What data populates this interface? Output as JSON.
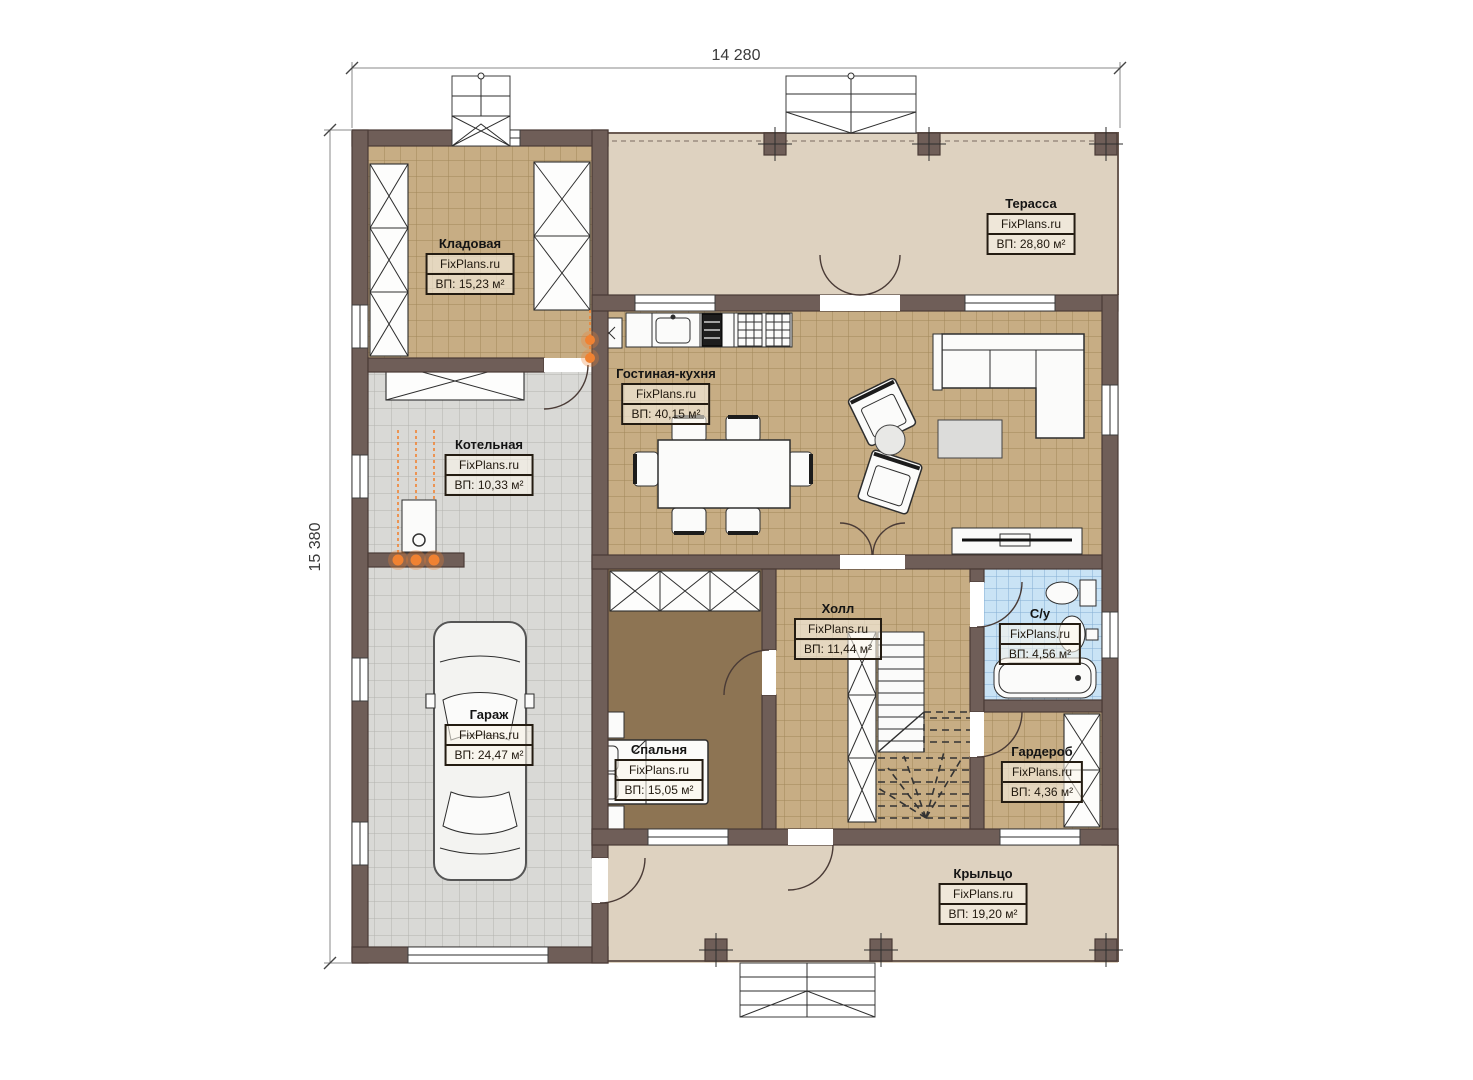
{
  "plan": {
    "title": "House first floor plan",
    "brand": "FixPlans.ru"
  },
  "dimensions": {
    "width_label": "14 280",
    "height_label": "15 380"
  },
  "rooms": [
    {
      "id": "kladovaya",
      "name": "Кладовая",
      "watermark": "FixPlans.ru",
      "area": "ВП: 15,23 м²"
    },
    {
      "id": "terrassa",
      "name": "Терасса",
      "watermark": "FixPlans.ru",
      "area": "ВП: 28,80 м²"
    },
    {
      "id": "kotelnaya",
      "name": "Котельная",
      "watermark": "FixPlans.ru",
      "area": "ВП: 10,33 м²"
    },
    {
      "id": "gostinaya",
      "name": "Гостиная-кухня",
      "watermark": "FixPlans.ru",
      "area": "ВП: 40,15 м²"
    },
    {
      "id": "garazh",
      "name": "Гараж",
      "watermark": "FixPlans.ru",
      "area": "ВП: 24,47 м²"
    },
    {
      "id": "spalnya",
      "name": "Спальня",
      "watermark": "FixPlans.ru",
      "area": "ВП: 15,05 м²"
    },
    {
      "id": "holl",
      "name": "Холл",
      "watermark": "FixPlans.ru",
      "area": "ВП: 11,44 м²"
    },
    {
      "id": "su",
      "name": "С/у",
      "watermark": "FixPlans.ru",
      "area": "ВП: 4,56 м²"
    },
    {
      "id": "garderob",
      "name": "Гардероб",
      "watermark": "FixPlans.ru",
      "area": "ВП: 4,36 м²"
    },
    {
      "id": "kryltso",
      "name": "Крыльцо",
      "watermark": "FixPlans.ru",
      "area": "ВП: 19,20 м²"
    }
  ],
  "colors": {
    "wall": "#6f5e58",
    "floor_tan": "#c7ad84",
    "floor_gray": "#d9d9d6",
    "floor_blue": "#c9e3f5",
    "floor_olive": "#8d7453",
    "outdoor": "#ded2c0",
    "orange": "#f08232"
  }
}
